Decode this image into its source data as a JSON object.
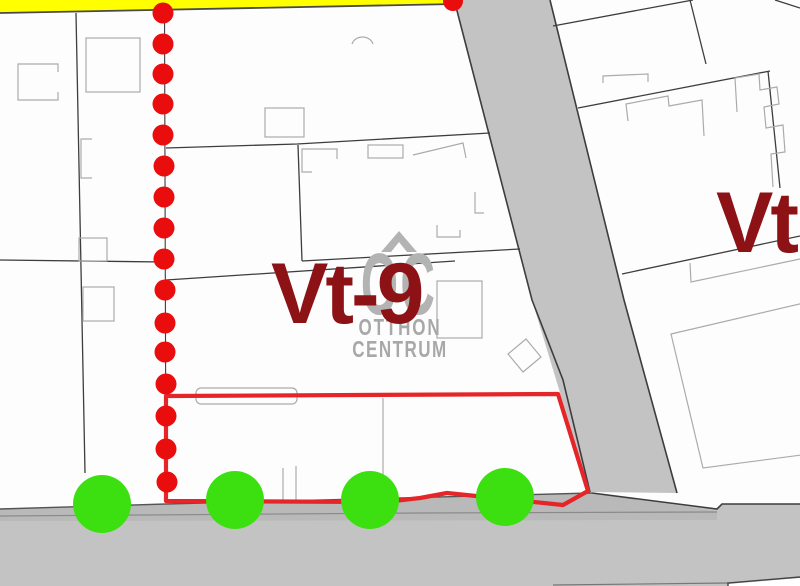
{
  "map_type": "cadastral-zoning-map",
  "labels": {
    "zone_main": "Vt-9",
    "zone_right": "Vt"
  },
  "watermark": {
    "logo_letters": "OC",
    "line1": "OTTHON",
    "line2": "CENTRUM"
  },
  "features": {
    "boundary_dots_count": 16,
    "boundary_dot_extra_top_right": 1,
    "tree_markers_count": 4,
    "highlighted_parcel": "red outlined parcel along bottom road",
    "roads": [
      "diagonal road right of dotted boundary",
      "horizontal road at bottom"
    ],
    "yellow_band": "yellow strip along top edge"
  },
  "colors": {
    "zone_text": "#8c1216",
    "boundary_dot": "#ea0d0d",
    "parcel_outline_red": "#e52528",
    "tree_green": "#3ce010",
    "road_gray": "#c3c3c3",
    "road_band_gray": "#b9b9b9",
    "yellow": "#ffff00",
    "watermark_logo": "#b3b3b3",
    "watermark_text": "#a8a8a8",
    "parcel_line": "#3d3d3d",
    "building_line": "#ababab"
  }
}
